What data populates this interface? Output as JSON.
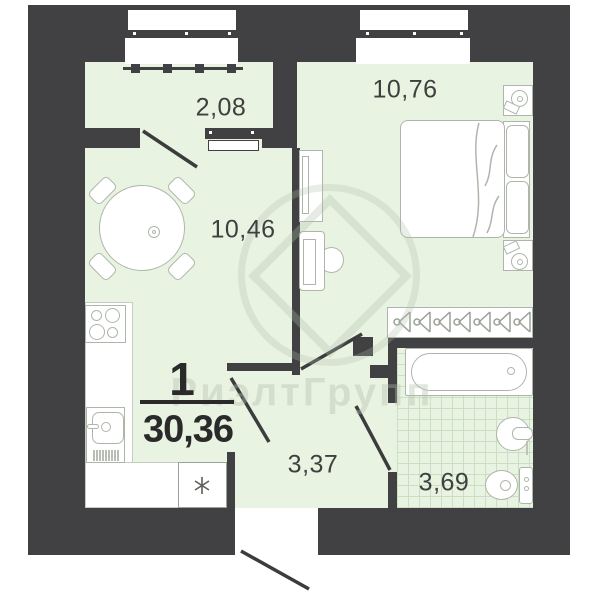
{
  "plan": {
    "rooms_count": "1",
    "total_area": "30,36",
    "rooms": [
      {
        "name": "balcony",
        "area": "2,08"
      },
      {
        "name": "bedroom",
        "area": "10,76"
      },
      {
        "name": "living-kitchen",
        "area": "10,46"
      },
      {
        "name": "hallway",
        "area": "3,37"
      },
      {
        "name": "bathroom",
        "area": "3,69"
      }
    ],
    "watermark_text": "РиэлтГрупп",
    "colors": {
      "wall": "#414143",
      "floor_fill": "#e9f3e1",
      "tile_line": "#cbdfc4",
      "furniture_outline": "#aeb6ab",
      "label_text": "#3e4040",
      "label_bold": "#2a2a2a"
    },
    "symbols": {
      "appliance_marker": "asterisk-icon",
      "wardrobe_marker": "hanger-icon",
      "door_swing": "door-leaf-line"
    }
  }
}
